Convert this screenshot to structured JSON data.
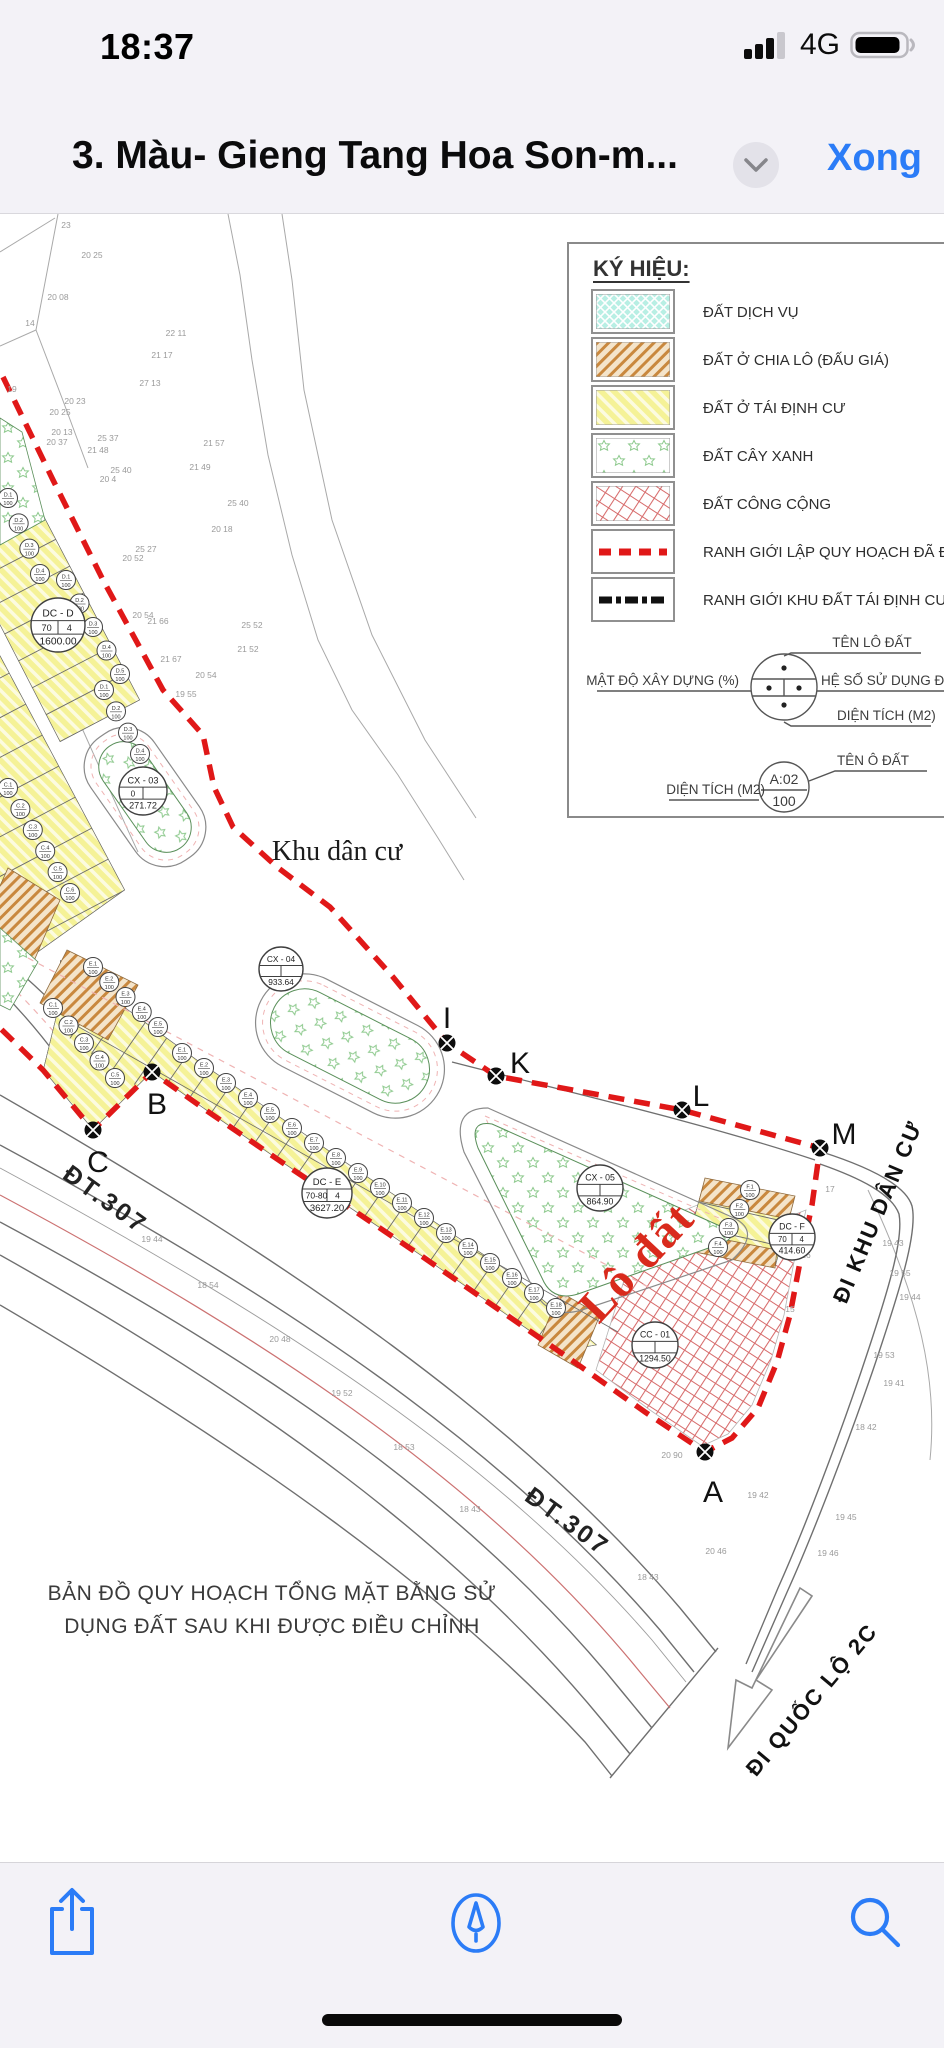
{
  "colors": {
    "accent_blue": "#2b7cf7",
    "boundary_red": "#e01818",
    "lot_yellow": "#f5f297",
    "hatch_orange": "#c9883e",
    "service_cyan": "#b8efe4",
    "green_tree": "#8cc98c",
    "public_red": "#d76b6b",
    "chrome_bg": "#f3f2f7"
  },
  "status_bar": {
    "time": "18:37",
    "network": "4G"
  },
  "nav_bar": {
    "title": "3. Màu- Gieng Tang Hoa Son-m...",
    "done_label": "Xong"
  },
  "legend": {
    "title": "KÝ HIỆU:",
    "items": [
      {
        "label": "ĐẤT DỊCH VỤ",
        "swatch": "cyan-crosshatch"
      },
      {
        "label": "ĐẤT Ở CHIA LÔ (ĐẤU GIÁ)",
        "swatch": "orange-hatch"
      },
      {
        "label": "ĐẤT Ở TÁI ĐỊNH CƯ",
        "swatch": "yellow-hatch"
      },
      {
        "label": "ĐẤT CÂY XANH",
        "swatch": "green-stars"
      },
      {
        "label": "ĐẤT CÔNG CỘNG",
        "swatch": "red-grid"
      },
      {
        "label": "RANH GIỚI LẬP QUY HOẠCH ĐÃ ĐƯỢC PHÊ DU",
        "swatch": "red-dashed-line"
      },
      {
        "label": "RANH GIỚI  KHU ĐẤT TÁI ĐỊNH CƯ, ĐẤT DỊCH V",
        "swatch": "black-dashed-line"
      }
    ],
    "diagram_labels": {
      "top": "TÊN LÔ ĐẤT",
      "left": "MẬT ĐỘ XÂY DỰNG (%)",
      "right": "HỆ SỐ SỬ DỤNG ĐẤ",
      "bottom": "DIỆN TÍCH (M2)"
    },
    "sample": {
      "left_label": "DIỆN TÍCH (M2)",
      "circle_top": "A:02",
      "circle_bottom": "100",
      "right_label": "TÊN Ô ĐẤT"
    }
  },
  "map": {
    "labels": {
      "khu_dan_cu": "Khu dân cư",
      "lo_dat": "Lô đất",
      "dt307": "ĐT.307",
      "di_khu_dan_cu": "ĐI KHU DÂN CƯ",
      "di_quoc_lo": "ĐI QUỐC LỘ 2C"
    },
    "caption_line1": "BẢN ĐỒ QUY HOẠCH TỔNG MẶT BẰNG SỬ",
    "caption_line2": "DỤNG ĐẤT SAU KHI ĐƯỢC ĐIỀU CHỈNH",
    "plots": [
      {
        "name": "DC - D",
        "d": "70",
        "c": "4",
        "area": "1600.00",
        "x": 58,
        "y": 625,
        "r": 27
      },
      {
        "name": "CX - 03",
        "d": "0",
        "c": "",
        "area": "271.72",
        "x": 143,
        "y": 791,
        "r": 24
      },
      {
        "name": "CX - 04",
        "d": "",
        "c": "",
        "area": "933.64",
        "x": 281,
        "y": 969,
        "r": 22
      },
      {
        "name": "DC - E",
        "d": "70-80",
        "c": "4",
        "area": "3627.20",
        "x": 327,
        "y": 1193,
        "r": 25
      },
      {
        "name": "CX - 05",
        "d": "",
        "c": "",
        "area": "864.90",
        "x": 600,
        "y": 1188,
        "r": 23
      },
      {
        "name": "DC - F",
        "d": "70",
        "c": "4",
        "area": "414.60",
        "x": 792,
        "y": 1237,
        "r": 23
      },
      {
        "name": "CC - 01",
        "d": "",
        "c": "",
        "area": "1294.50",
        "x": 655,
        "y": 1345,
        "r": 23
      }
    ],
    "points": [
      {
        "label": "I",
        "x": 447,
        "y": 1043,
        "lx": 447,
        "ly": 1018
      },
      {
        "label": "K",
        "x": 496,
        "y": 1076,
        "lx": 520,
        "ly": 1063
      },
      {
        "label": "L",
        "x": 682,
        "y": 1110,
        "lx": 701,
        "ly": 1096
      },
      {
        "label": "M",
        "x": 820,
        "y": 1148,
        "lx": 844,
        "ly": 1134
      },
      {
        "label": "B",
        "x": 152,
        "y": 1072,
        "lx": 157,
        "ly": 1104
      },
      {
        "label": "C",
        "x": 93,
        "y": 1130,
        "lx": 98,
        "ly": 1162
      },
      {
        "label": "A",
        "x": 705,
        "y": 1452,
        "lx": 713,
        "ly": 1492
      }
    ],
    "strips": [
      {
        "poly": "0,432 140,700 60,742 -80,470",
        "e": [
          0,
          432,
          140,
          700
        ],
        "p": [
          -0.886,
          0.46
        ],
        "len": 100,
        "n": 11
      },
      {
        "poly": "-40,580 125,890 20,965 -145,655",
        "e": [
          -40,
          580,
          125,
          890
        ],
        "p": [
          -0.885,
          0.466
        ],
        "len": 115,
        "n": 11
      },
      {
        "poly": "60,960 200,1062 350,1165 510,1272 597,1345 560,1352 423,1257 283,1163 210,1113 152,1072 93,1130 43,1070 60,1000",
        "e": [
          60,
          960,
          597,
          1345
        ],
        "p": [
          -0.57,
          0.82
        ],
        "len": 58,
        "n": 26
      },
      {
        "poly": "705,1178 795,1196 775,1268 685,1250",
        "e": [
          705,
          1178,
          685,
          1250
        ],
        "p": [
          0.975,
          0.22
        ],
        "len": 95,
        "n": 4
      }
    ],
    "lot_chains": [
      {
        "p": "D",
        "x1": 8,
        "y1": 498,
        "x2": 40,
        "y2": 574,
        "n": 4
      },
      {
        "p": "D",
        "x1": 66,
        "y1": 580,
        "x2": 120,
        "y2": 674,
        "n": 5
      },
      {
        "p": "D",
        "x1": 104,
        "y1": 690,
        "x2": 140,
        "y2": 754,
        "n": 4
      },
      {
        "p": "C",
        "x1": 8,
        "y1": 788,
        "x2": 70,
        "y2": 893,
        "n": 6
      },
      {
        "p": "C",
        "x1": 53,
        "y1": 1008,
        "x2": 115,
        "y2": 1078,
        "n": 5
      },
      {
        "p": "E",
        "x1": 93,
        "y1": 967,
        "x2": 158,
        "y2": 1027,
        "n": 5
      },
      {
        "p": "E",
        "x1": 182,
        "y1": 1053,
        "x2": 556,
        "y2": 1308,
        "n": 18
      },
      {
        "p": "F",
        "x1": 750,
        "y1": 1190,
        "x2": 718,
        "y2": 1247,
        "n": 4
      }
    ],
    "survey_numbers": [
      {
        "x": 66,
        "y": 228,
        "t": "23"
      },
      {
        "x": 92,
        "y": 258,
        "t": "20 25"
      },
      {
        "x": 58,
        "y": 300,
        "t": "20 08"
      },
      {
        "x": 30,
        "y": 326,
        "t": "14"
      },
      {
        "x": 176,
        "y": 336,
        "t": "22 11"
      },
      {
        "x": 162,
        "y": 358,
        "t": "21 17"
      },
      {
        "x": 150,
        "y": 386,
        "t": "27 13"
      },
      {
        "x": 12,
        "y": 392,
        "t": "19"
      },
      {
        "x": 75,
        "y": 404,
        "t": "20 23"
      },
      {
        "x": 60,
        "y": 415,
        "t": "20 25"
      },
      {
        "x": 62,
        "y": 435,
        "t": "20 13"
      },
      {
        "x": 57,
        "y": 445,
        "t": "20 37"
      },
      {
        "x": 108,
        "y": 441,
        "t": "25 37"
      },
      {
        "x": 98,
        "y": 453,
        "t": "21 48"
      },
      {
        "x": 121,
        "y": 473,
        "t": "25 40"
      },
      {
        "x": 108,
        "y": 482,
        "t": "20 4"
      },
      {
        "x": 146,
        "y": 552,
        "t": "25 27"
      },
      {
        "x": 133,
        "y": 561,
        "t": "20 52"
      },
      {
        "x": 143,
        "y": 618,
        "t": "20 54"
      },
      {
        "x": 158,
        "y": 624,
        "t": "21 66"
      },
      {
        "x": 171,
        "y": 662,
        "t": "21 67"
      },
      {
        "x": 186,
        "y": 697,
        "t": "19 55"
      },
      {
        "x": 206,
        "y": 678,
        "t": "20 54"
      },
      {
        "x": 238,
        "y": 506,
        "t": "25 40"
      },
      {
        "x": 222,
        "y": 532,
        "t": "20 18"
      },
      {
        "x": 214,
        "y": 446,
        "t": "21 57"
      },
      {
        "x": 200,
        "y": 470,
        "t": "21 49"
      },
      {
        "x": 252,
        "y": 628,
        "t": "25 52"
      },
      {
        "x": 248,
        "y": 652,
        "t": "21 52"
      },
      {
        "x": 900,
        "y": 1276,
        "t": "19 55"
      },
      {
        "x": 910,
        "y": 1300,
        "t": "19 44"
      },
      {
        "x": 884,
        "y": 1358,
        "t": "19 53"
      },
      {
        "x": 894,
        "y": 1386,
        "t": "19 41"
      },
      {
        "x": 866,
        "y": 1430,
        "t": "18 42"
      },
      {
        "x": 846,
        "y": 1520,
        "t": "19 45"
      },
      {
        "x": 828,
        "y": 1556,
        "t": "19 46"
      },
      {
        "x": 758,
        "y": 1498,
        "t": "19 42"
      },
      {
        "x": 716,
        "y": 1554,
        "t": "20 46"
      },
      {
        "x": 648,
        "y": 1580,
        "t": "18 43"
      },
      {
        "x": 893,
        "y": 1246,
        "t": "19 43"
      },
      {
        "x": 152,
        "y": 1242,
        "t": "19 44"
      },
      {
        "x": 208,
        "y": 1288,
        "t": "18 54"
      },
      {
        "x": 280,
        "y": 1342,
        "t": "20 48"
      },
      {
        "x": 342,
        "y": 1396,
        "t": "19 52"
      },
      {
        "x": 404,
        "y": 1450,
        "t": "18 53"
      },
      {
        "x": 470,
        "y": 1512,
        "t": "18 43"
      },
      {
        "x": 672,
        "y": 1458,
        "t": "20 90"
      },
      {
        "x": 830,
        "y": 1192,
        "t": "17"
      },
      {
        "x": 806,
        "y": 1258,
        "t": "16"
      },
      {
        "x": 790,
        "y": 1312,
        "t": "15"
      }
    ]
  },
  "toolbar": {
    "icons": [
      "share",
      "markup",
      "search"
    ]
  }
}
